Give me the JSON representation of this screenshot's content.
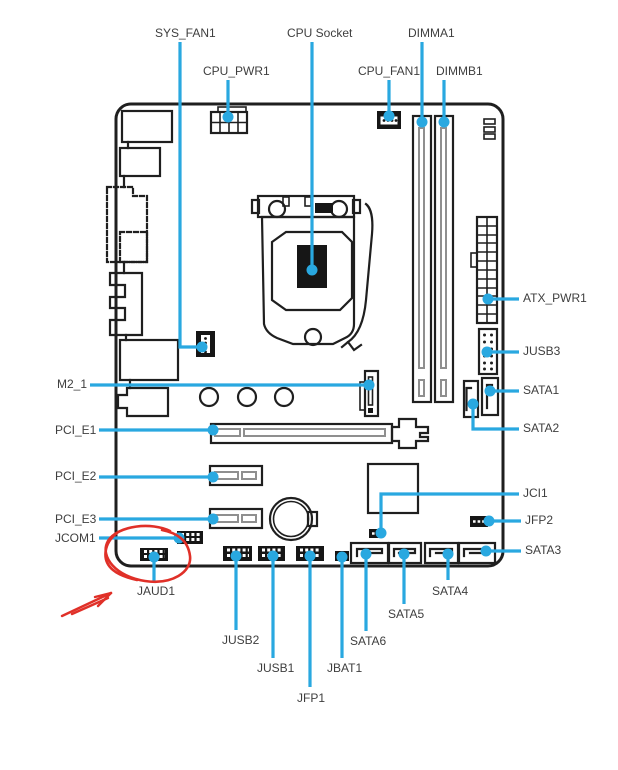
{
  "figure": {
    "type": "motherboard-connector-location-diagram",
    "description": "Line-art motherboard layout with leader lines pointing to connector labels"
  },
  "colors": {
    "leader_line": "#29a8e0",
    "artwork": "#1f1f1f",
    "slot_inner_gray": "#8f8f8f",
    "label_text": "#3e3e3e",
    "annotation_red": "#e03028",
    "background": "#ffffff"
  },
  "labels": {
    "sys_fan1": "SYS_FAN1",
    "cpu_pwr1": "CPU_PWR1",
    "cpu_socket": "CPU Socket",
    "dimma1": "DIMMA1",
    "cpu_fan1": "CPU_FAN1",
    "dimmb1": "DIMMB1",
    "atx_pwr1": "ATX_PWR1",
    "jusb3": "JUSB3",
    "sata1": "SATA1",
    "sata2": "SATA2",
    "jci1": "JCI1",
    "jfp2": "JFP2",
    "sata3": "SATA3",
    "m2_1": "M2_1",
    "pci_e1": "PCI_E1",
    "pci_e2": "PCI_E2",
    "pci_e3": "PCI_E3",
    "jcom1": "JCOM1",
    "jaud1": "JAUD1",
    "jusb2": "JUSB2",
    "jusb1": "JUSB1",
    "jfp1": "JFP1",
    "jbat1": "JBAT1",
    "sata6": "SATA6",
    "sata5": "SATA5",
    "sata4": "SATA4"
  },
  "annotation": {
    "color": "#e03028",
    "target": "JAUD1",
    "marks": [
      "hand-drawn red circle around the JAUD1 front-audio header",
      "hand-drawn red arrow pointing up-right at the circled JAUD1 header"
    ]
  }
}
